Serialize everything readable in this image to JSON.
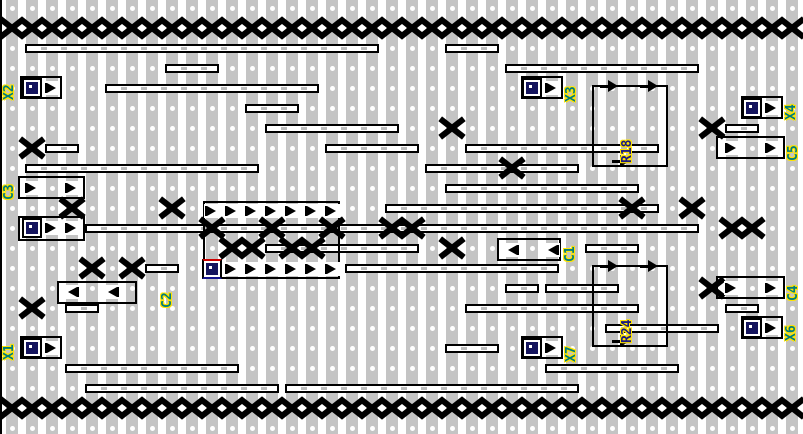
{
  "board": {
    "width": 803,
    "height": 434,
    "cols": 40,
    "rows": 22,
    "origin_x": 12,
    "origin_y": 8,
    "pitch": 20,
    "strip_width": 12,
    "strip_color": "#c4c4c4",
    "hole_color": "#ffffff",
    "break_color": "#000000",
    "label_color_net": "#007c7c",
    "label_color_part": "#1a1a80",
    "label_halo": "#ffe400"
  },
  "breaks": {
    "full_rows": [
      1,
      20
    ],
    "cells": [
      [
        22,
        6
      ],
      [
        35,
        6
      ],
      [
        1,
        7
      ],
      [
        25,
        8
      ],
      [
        3,
        10
      ],
      [
        8,
        10
      ],
      [
        31,
        10
      ],
      [
        34,
        10
      ],
      [
        10,
        11
      ],
      [
        13,
        11
      ],
      [
        16,
        11
      ],
      [
        19,
        11
      ],
      [
        20,
        11
      ],
      [
        36,
        11
      ],
      [
        37,
        11
      ],
      [
        11,
        12
      ],
      [
        12,
        12
      ],
      [
        14,
        12
      ],
      [
        15,
        12
      ],
      [
        22,
        12
      ],
      [
        4,
        13
      ],
      [
        6,
        13
      ],
      [
        35,
        14
      ],
      [
        1,
        15
      ]
    ]
  },
  "wires": [
    [
      2,
      1,
      18
    ],
    [
      2,
      22,
      24
    ],
    [
      3,
      8,
      10
    ],
    [
      3,
      25,
      34
    ],
    [
      4,
      5,
      15
    ],
    [
      5,
      12,
      14
    ],
    [
      6,
      13,
      19
    ],
    [
      6,
      36,
      37
    ],
    [
      7,
      2,
      3
    ],
    [
      7,
      16,
      20
    ],
    [
      7,
      23,
      32
    ],
    [
      8,
      1,
      12
    ],
    [
      8,
      21,
      28
    ],
    [
      9,
      22,
      31
    ],
    [
      10,
      19,
      32
    ],
    [
      11,
      4,
      34
    ],
    [
      12,
      13,
      20
    ],
    [
      12,
      29,
      31
    ],
    [
      13,
      7,
      8
    ],
    [
      13,
      17,
      27
    ],
    [
      14,
      25,
      26
    ],
    [
      14,
      27,
      30
    ],
    [
      15,
      3,
      4
    ],
    [
      15,
      23,
      31
    ],
    [
      15,
      36,
      37
    ],
    [
      16,
      30,
      35
    ],
    [
      17,
      22,
      24
    ],
    [
      18,
      3,
      11
    ],
    [
      18,
      27,
      33
    ],
    [
      19,
      4,
      13
    ],
    [
      19,
      14,
      28
    ]
  ],
  "components": [
    {
      "name": "connector-X2",
      "box": [
        20,
        76,
        42,
        23
      ],
      "pins": [
        {
          "kind": "special",
          "x": 32,
          "y": 88
        },
        {
          "kind": "tri-r",
          "x": 52,
          "y": 88
        }
      ]
    },
    {
      "name": "connector-X3",
      "box": [
        521,
        76,
        42,
        23
      ],
      "pins": [
        {
          "kind": "special",
          "x": 532,
          "y": 88
        },
        {
          "kind": "tri-r",
          "x": 552,
          "y": 88
        }
      ]
    },
    {
      "name": "connector-X4",
      "box": [
        741,
        96,
        42,
        23
      ],
      "pins": [
        {
          "kind": "special",
          "x": 752,
          "y": 108
        },
        {
          "kind": "tri-r",
          "x": 772,
          "y": 108
        }
      ]
    },
    {
      "name": "capacitor-C5",
      "box": [
        716,
        136,
        69,
        23
      ],
      "pins": [
        {
          "kind": "tri-r",
          "x": 732,
          "y": 148
        },
        {
          "kind": "tri-r",
          "x": 772,
          "y": 148
        }
      ]
    },
    {
      "name": "capacitor-C3",
      "box": [
        18,
        176,
        67,
        23
      ],
      "pins": [
        {
          "kind": "tri-r",
          "x": 32,
          "y": 188
        },
        {
          "kind": "tri-r",
          "x": 72,
          "y": 188
        }
      ]
    },
    {
      "name": "connector-unlabeled",
      "box": [
        18,
        216,
        67,
        25
      ],
      "pins": [
        {
          "kind": "special",
          "x": 32,
          "y": 228
        },
        {
          "kind": "tri-r",
          "x": 52,
          "y": 228
        },
        {
          "kind": "tri-r",
          "x": 72,
          "y": 228
        }
      ]
    },
    {
      "name": "ic-dip14",
      "box": [
        203,
        201,
        137,
        78
      ],
      "pins": [
        {
          "kind": "tri-r",
          "x": 212,
          "y": 211
        },
        {
          "kind": "tri-r",
          "x": 232,
          "y": 211
        },
        {
          "kind": "tri-r",
          "x": 252,
          "y": 211
        },
        {
          "kind": "tri-r",
          "x": 272,
          "y": 211
        },
        {
          "kind": "tri-r",
          "x": 292,
          "y": 211
        },
        {
          "kind": "tri-r",
          "x": 312,
          "y": 211
        },
        {
          "kind": "tri-r",
          "x": 332,
          "y": 211
        },
        {
          "kind": "special-ic1",
          "x": 212,
          "y": 269
        },
        {
          "kind": "tri-r",
          "x": 232,
          "y": 269
        },
        {
          "kind": "tri-r",
          "x": 252,
          "y": 269
        },
        {
          "kind": "tri-r",
          "x": 272,
          "y": 269
        },
        {
          "kind": "tri-r",
          "x": 292,
          "y": 269
        },
        {
          "kind": "tri-r",
          "x": 312,
          "y": 269
        },
        {
          "kind": "tri-r",
          "x": 332,
          "y": 269
        }
      ]
    },
    {
      "name": "capacitor-C1",
      "box": [
        497,
        238,
        64,
        23
      ],
      "pins": [
        {
          "kind": "tri-l",
          "x": 512,
          "y": 250
        },
        {
          "kind": "tri-l",
          "x": 552,
          "y": 250
        }
      ]
    },
    {
      "name": "capacitor-C2",
      "box": [
        57,
        281,
        80,
        23
      ],
      "pins": [
        {
          "kind": "tri-l",
          "x": 72,
          "y": 292
        },
        {
          "kind": "tri-l",
          "x": 112,
          "y": 292
        }
      ]
    },
    {
      "name": "resistor-R18",
      "box": [
        592,
        85,
        76,
        82
      ],
      "pins": [
        {
          "kind": "arrow-r",
          "x": 602,
          "y": 86
        },
        {
          "kind": "arrow-r",
          "x": 642,
          "y": 86
        },
        {
          "kind": "arrow-r",
          "x": 614,
          "y": 161
        }
      ]
    },
    {
      "name": "resistor-R24",
      "box": [
        592,
        265,
        76,
        82
      ],
      "pins": [
        {
          "kind": "arrow-r",
          "x": 602,
          "y": 266
        },
        {
          "kind": "arrow-r",
          "x": 642,
          "y": 266
        },
        {
          "kind": "arrow-r",
          "x": 614,
          "y": 341
        }
      ]
    },
    {
      "name": "capacitor-C4",
      "box": [
        716,
        276,
        69,
        23
      ],
      "pins": [
        {
          "kind": "tri-r",
          "x": 732,
          "y": 288
        },
        {
          "kind": "tri-r",
          "x": 772,
          "y": 288
        }
      ]
    },
    {
      "name": "connector-X6",
      "box": [
        741,
        316,
        42,
        23
      ],
      "pins": [
        {
          "kind": "special",
          "x": 752,
          "y": 328
        },
        {
          "kind": "tri-r",
          "x": 772,
          "y": 328
        }
      ]
    },
    {
      "name": "connector-X1",
      "box": [
        20,
        336,
        42,
        23
      ],
      "pins": [
        {
          "kind": "special",
          "x": 32,
          "y": 348
        },
        {
          "kind": "tri-r",
          "x": 52,
          "y": 348
        }
      ]
    },
    {
      "name": "connector-X7",
      "box": [
        521,
        336,
        42,
        23
      ],
      "pins": [
        {
          "kind": "special",
          "x": 532,
          "y": 348
        },
        {
          "kind": "tri-r",
          "x": 552,
          "y": 348
        }
      ]
    }
  ],
  "labels": [
    {
      "text": "X2",
      "x": 2,
      "y": 100,
      "kind": "net"
    },
    {
      "text": "X3",
      "x": 564,
      "y": 102,
      "kind": "net"
    },
    {
      "text": "X4",
      "x": 784,
      "y": 120,
      "kind": "net"
    },
    {
      "text": "C5",
      "x": 786,
      "y": 161,
      "kind": "net"
    },
    {
      "text": "C3",
      "x": 2,
      "y": 200,
      "kind": "net"
    },
    {
      "text": "R18",
      "x": 620,
      "y": 163,
      "kind": "part"
    },
    {
      "text": "C1",
      "x": 563,
      "y": 262,
      "kind": "net"
    },
    {
      "text": "C2",
      "x": 160,
      "y": 308,
      "kind": "net"
    },
    {
      "text": "R24",
      "x": 620,
      "y": 343,
      "kind": "part"
    },
    {
      "text": "C4",
      "x": 786,
      "y": 301,
      "kind": "net"
    },
    {
      "text": "X6",
      "x": 784,
      "y": 341,
      "kind": "net"
    },
    {
      "text": "X1",
      "x": 2,
      "y": 360,
      "kind": "net"
    },
    {
      "text": "X7",
      "x": 564,
      "y": 362,
      "kind": "net"
    }
  ]
}
